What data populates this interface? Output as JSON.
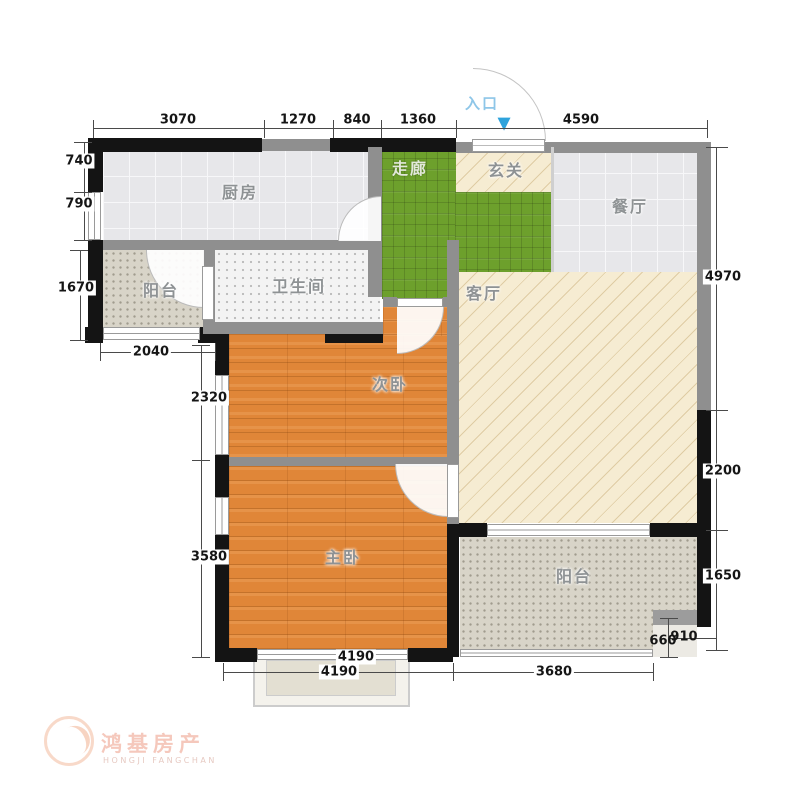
{
  "rooms": {
    "kitchen": "厨房",
    "corridor": "走廊",
    "foyer": "玄关",
    "dining": "餐厅",
    "balcony_left": "阳台",
    "bathroom": "卫生间",
    "living": "客厅",
    "bedroom_second": "次卧",
    "bedroom_master": "主卧",
    "balcony_south": "阳台"
  },
  "entrance": {
    "label": "入口",
    "arrow": "▼"
  },
  "dims": {
    "top": [
      "3070",
      "1270",
      "840",
      "1360",
      "4590"
    ],
    "left": [
      "740",
      "790",
      "1670",
      "2040"
    ],
    "bedroom_left": [
      "2320",
      "3580"
    ],
    "bottom": [
      "4190",
      "4190",
      "3680"
    ],
    "right": [
      "4970",
      "2200",
      "1650"
    ],
    "small": [
      "660",
      "910"
    ]
  },
  "watermark": {
    "name": "鸿基房产",
    "sub": "HONGJI FANGCHAN"
  },
  "colors": {
    "wall_black": "#141414",
    "wall_gray": "#8f8f8f",
    "floor_wood": "#e08638",
    "floor_green": "#6da02c",
    "floor_beige": "#f6ecd2",
    "floor_tile": "#e7e7ea",
    "entrance_blue": "#2ea3dc"
  }
}
